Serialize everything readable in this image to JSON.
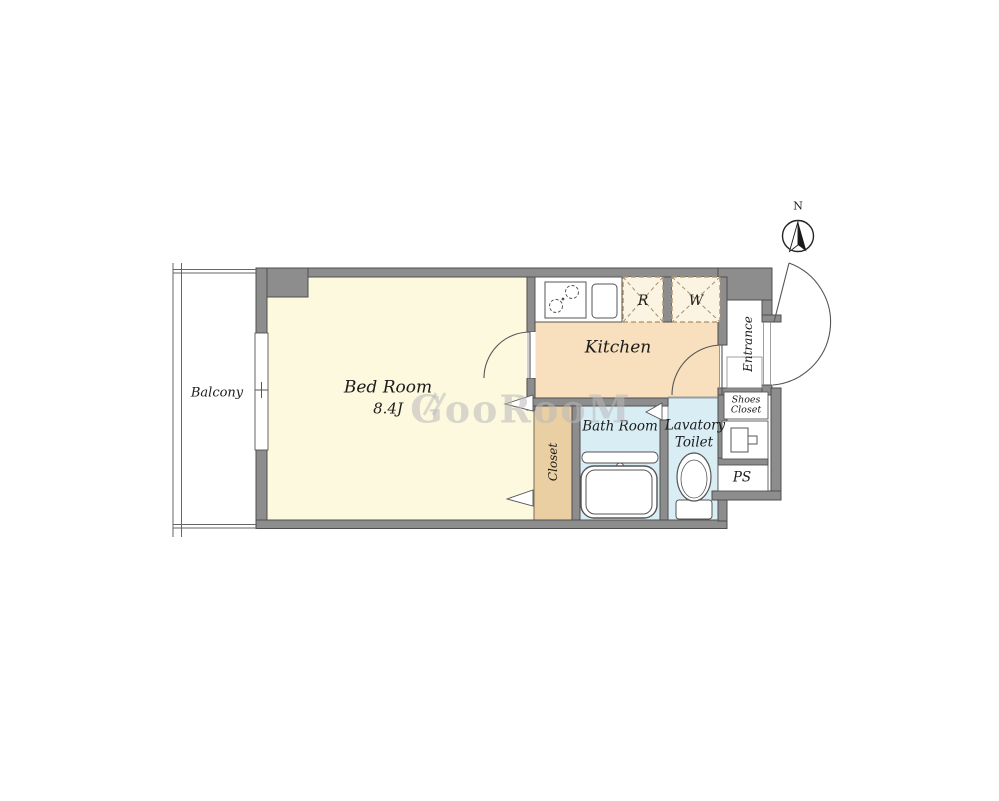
{
  "compass": {
    "north_label": "N"
  },
  "watermark": {
    "text": "GooRooM"
  },
  "rooms": {
    "balcony": {
      "label": "Balcony"
    },
    "bedroom": {
      "label": "Bed Room",
      "size": "8.4J"
    },
    "kitchen": {
      "label": "Kitchen"
    },
    "closet": {
      "label": "Closet"
    },
    "bath": {
      "label": "Bath Room"
    },
    "lavatory": {
      "label_line1": "Lavatory",
      "label_line2": "Toilet"
    },
    "entrance": {
      "label": "Entrance"
    },
    "shoes_closet": {
      "label_line1": "Shoes",
      "label_line2": "Closet"
    },
    "pipe_space": {
      "label": "PS"
    }
  },
  "appliance_spaces": {
    "refrigerator": {
      "label": "R"
    },
    "washer": {
      "label": "W"
    }
  },
  "colors": {
    "wall": "#8d8d8d",
    "wall_outline": "#4e4e4e",
    "bedroom_floor": "#fdf9df",
    "kitchen_floor": "#f8dfbd",
    "closet_floor": "#e9cfa2",
    "bath_floor": "#d9edf4",
    "appliance_box_fill": "#fbf4e2",
    "appliance_box_border": "#a8906a",
    "watermark": "#bababa"
  }
}
